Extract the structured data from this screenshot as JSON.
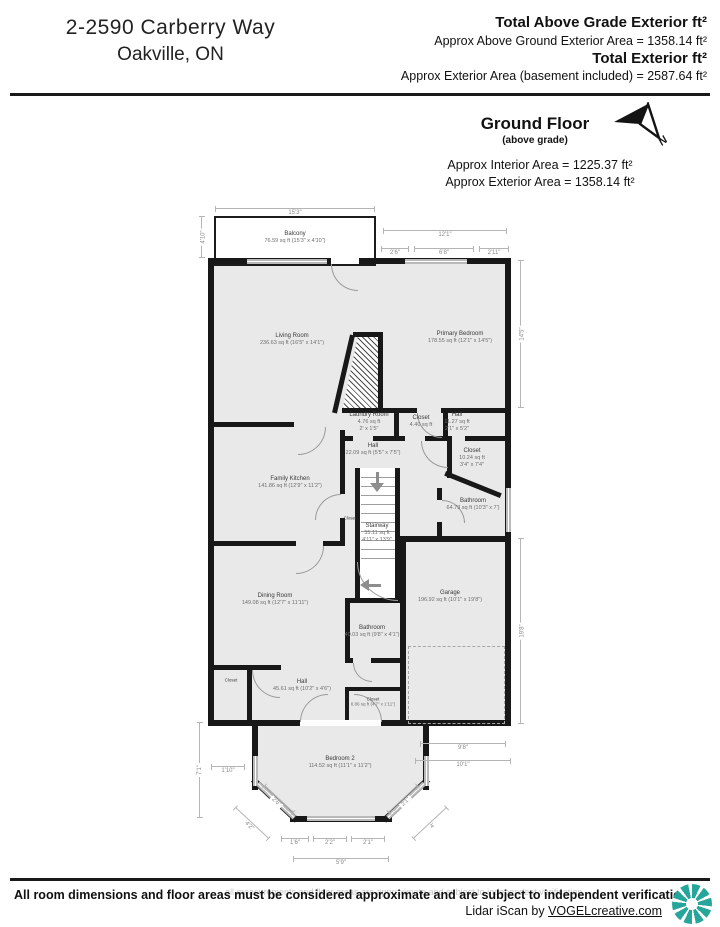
{
  "header": {
    "address_line1": "2-2590 Carberry Way",
    "address_line2": "Oakville,  ON",
    "totals": [
      {
        "label": "Total Above Grade Exterior ft²",
        "detail": "Approx Above Ground Exterior Area = 1358.14 ft²"
      },
      {
        "label": "Total Exterior ft²",
        "detail": "Approx Exterior Area (basement included) = 2587.64 ft²"
      }
    ]
  },
  "floor_header": {
    "title": "Ground Floor",
    "subtitle": "(above grade)",
    "north": "N",
    "interior_area": "Approx Interior Area = 1225.37 ft²",
    "exterior_area": "Approx Exterior Area = 1358.14 ft²"
  },
  "rooms": [
    {
      "name": "Balcony",
      "line2": "76.59 sq ft (15'3\" x 4'10\")"
    },
    {
      "name": "Living Room",
      "line2": "236.63 sq ft (16'5\" x 14'1\")"
    },
    {
      "name": "Primary Bedroom",
      "line2": "178.55 sq ft (12'1\" x 14'5\")"
    },
    {
      "name": "Laundry Room",
      "line2": "4.76 sq ft",
      "line3": "2' x 1'5\""
    },
    {
      "name": "Closet",
      "line2": "4.40 sq ft"
    },
    {
      "name": "Hall",
      "line2": "11.27 sq ft",
      "line3": "2'1\" x 5'2\""
    },
    {
      "name": "Closet",
      "line2": "10.24 sq ft",
      "line3": "3'4\" x 7'4\""
    },
    {
      "name": "Hall",
      "line2": "22.09 sq ft (5'5\" x 7'5\")"
    },
    {
      "name": "Family Kitchen",
      "line2": "141.86 sq ft (12'9\" x 11'2\")"
    },
    {
      "name": "Stairway",
      "line2": "55.11 sq ft",
      "line3": "4'11\" x 13'9\""
    },
    {
      "name": "Bathroom",
      "line2": "64.73 sq ft (10'3\" x 7')"
    },
    {
      "name": "Closet"
    },
    {
      "name": "Dining Room",
      "line2": "149.08 sq ft (12'7\" x 11'11\")"
    },
    {
      "name": "Garage",
      "line2": "196.92 sq ft (10'1\" x 19'8\")"
    },
    {
      "name": "Bathroom",
      "line2": "40.03 sq ft (9'8\" x 4'1\")"
    },
    {
      "name": "Hall",
      "line2": "45.61 sq ft (10'2\" x 4'6\")"
    },
    {
      "name": "Closet"
    },
    {
      "name": "Closet",
      "line2": "8.86 sq ft (4'7\" x 1'11\")"
    },
    {
      "name": "Bedroom 2",
      "line2": "114.52 sq ft (11'1\" x 11'2\")"
    }
  ],
  "dims": [
    "15'3\"",
    "4'10\"",
    "12'1\"",
    "2'6\"",
    "6'8\"",
    "2'11\"",
    "14'5\"",
    "19'8\"",
    "9'8\"",
    "10'1\"",
    "7'1\"",
    "5'9\"",
    "1'6\"",
    "2'2\"",
    "2'1\"",
    "2'6\"",
    "2'1\"",
    "4'2\"",
    "4'",
    "1'10\""
  ],
  "footer": {
    "disclaimer": "All room dimensions and floor areas must be considered approximate and are subject to independent verification.",
    "watermark": "all measurements and floor areas are approximate and subject to independent verification",
    "credit_prefix": "Lidar iScan by ",
    "credit_link": "VOGELcreative.com",
    "logo_icon": "pinwheel-logo"
  },
  "colors": {
    "wall": "#181818",
    "room_fill": "#e9e9e9",
    "logo_teal": "#26a69a",
    "dim_gray": "#8a8a8a"
  }
}
